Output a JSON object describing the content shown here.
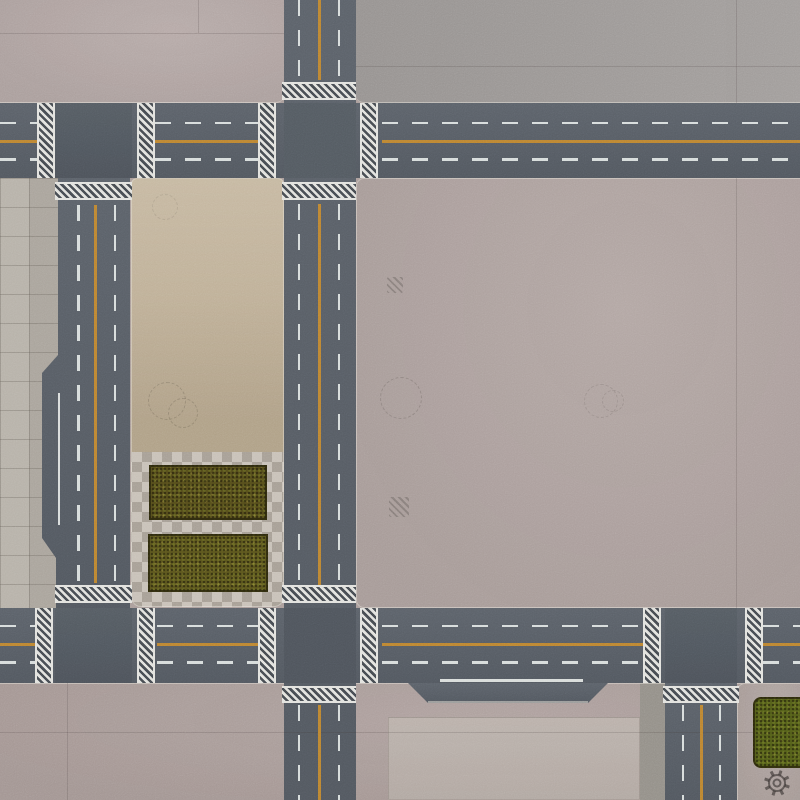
{
  "scene": {
    "kind": "tabletop-wargame-city-mat",
    "view": "top-down",
    "visible_text": []
  },
  "palette": {
    "asphalt": "#575d65",
    "concrete_pink": "#b2a5a3",
    "concrete_pink_mid": "#aea19e",
    "concrete_pink_deep": "#aa9c99",
    "concrete_gray": "#9d9997",
    "sidewalk": "#b3ada4",
    "dirt_tan": "#c0b199",
    "checker_light": "#c8c1b8",
    "pad_gray": "#b7ada7",
    "curb_gray": "#949089",
    "island_pink": "#aca09c",
    "grass_dark": "#564e1c",
    "grass_mid": "#5c561e",
    "grass_green": "#55601a",
    "lane_white": "#e5e8e6",
    "lane_orange": "#c6892f",
    "crosswalk_white": "#e2e2de",
    "crosswalk_dark": "#474c52"
  },
  "map": {
    "roads": [
      {
        "id": "top-horizontal",
        "orientation": "horizontal",
        "lanes": 2,
        "center_line": "orange-solid",
        "lane_lines": "white-dashed"
      },
      {
        "id": "bottom-horizontal",
        "orientation": "horizontal",
        "lanes": 2,
        "center_line": "orange-solid",
        "lane_lines": "white-dashed",
        "extra": "merge-pocket-with-solid-white-line"
      },
      {
        "id": "west-vertical",
        "orientation": "vertical",
        "lanes": 2,
        "center_line": "orange-solid",
        "extra": "parking-bay-with-solid-white-line"
      },
      {
        "id": "center-vertical",
        "orientation": "vertical",
        "lanes": 2,
        "center_line": "orange-solid"
      },
      {
        "id": "southeast-vertical",
        "orientation": "vertical",
        "lanes": 2,
        "center_line": "orange-solid"
      }
    ],
    "crosswalks": 15,
    "zones": [
      "plaza-top-left",
      "plaza-top-right",
      "sidewalk-west",
      "dirt-lot",
      "checkered-court",
      "plaza-center-right",
      "south-apron",
      "concrete-pad",
      "curb-strip-southeast",
      "island-southeast"
    ],
    "grass_patches": 3,
    "manhole_circles": 6,
    "utility_hatches": 2
  },
  "watermark": {
    "icon": "gear-emblem"
  }
}
